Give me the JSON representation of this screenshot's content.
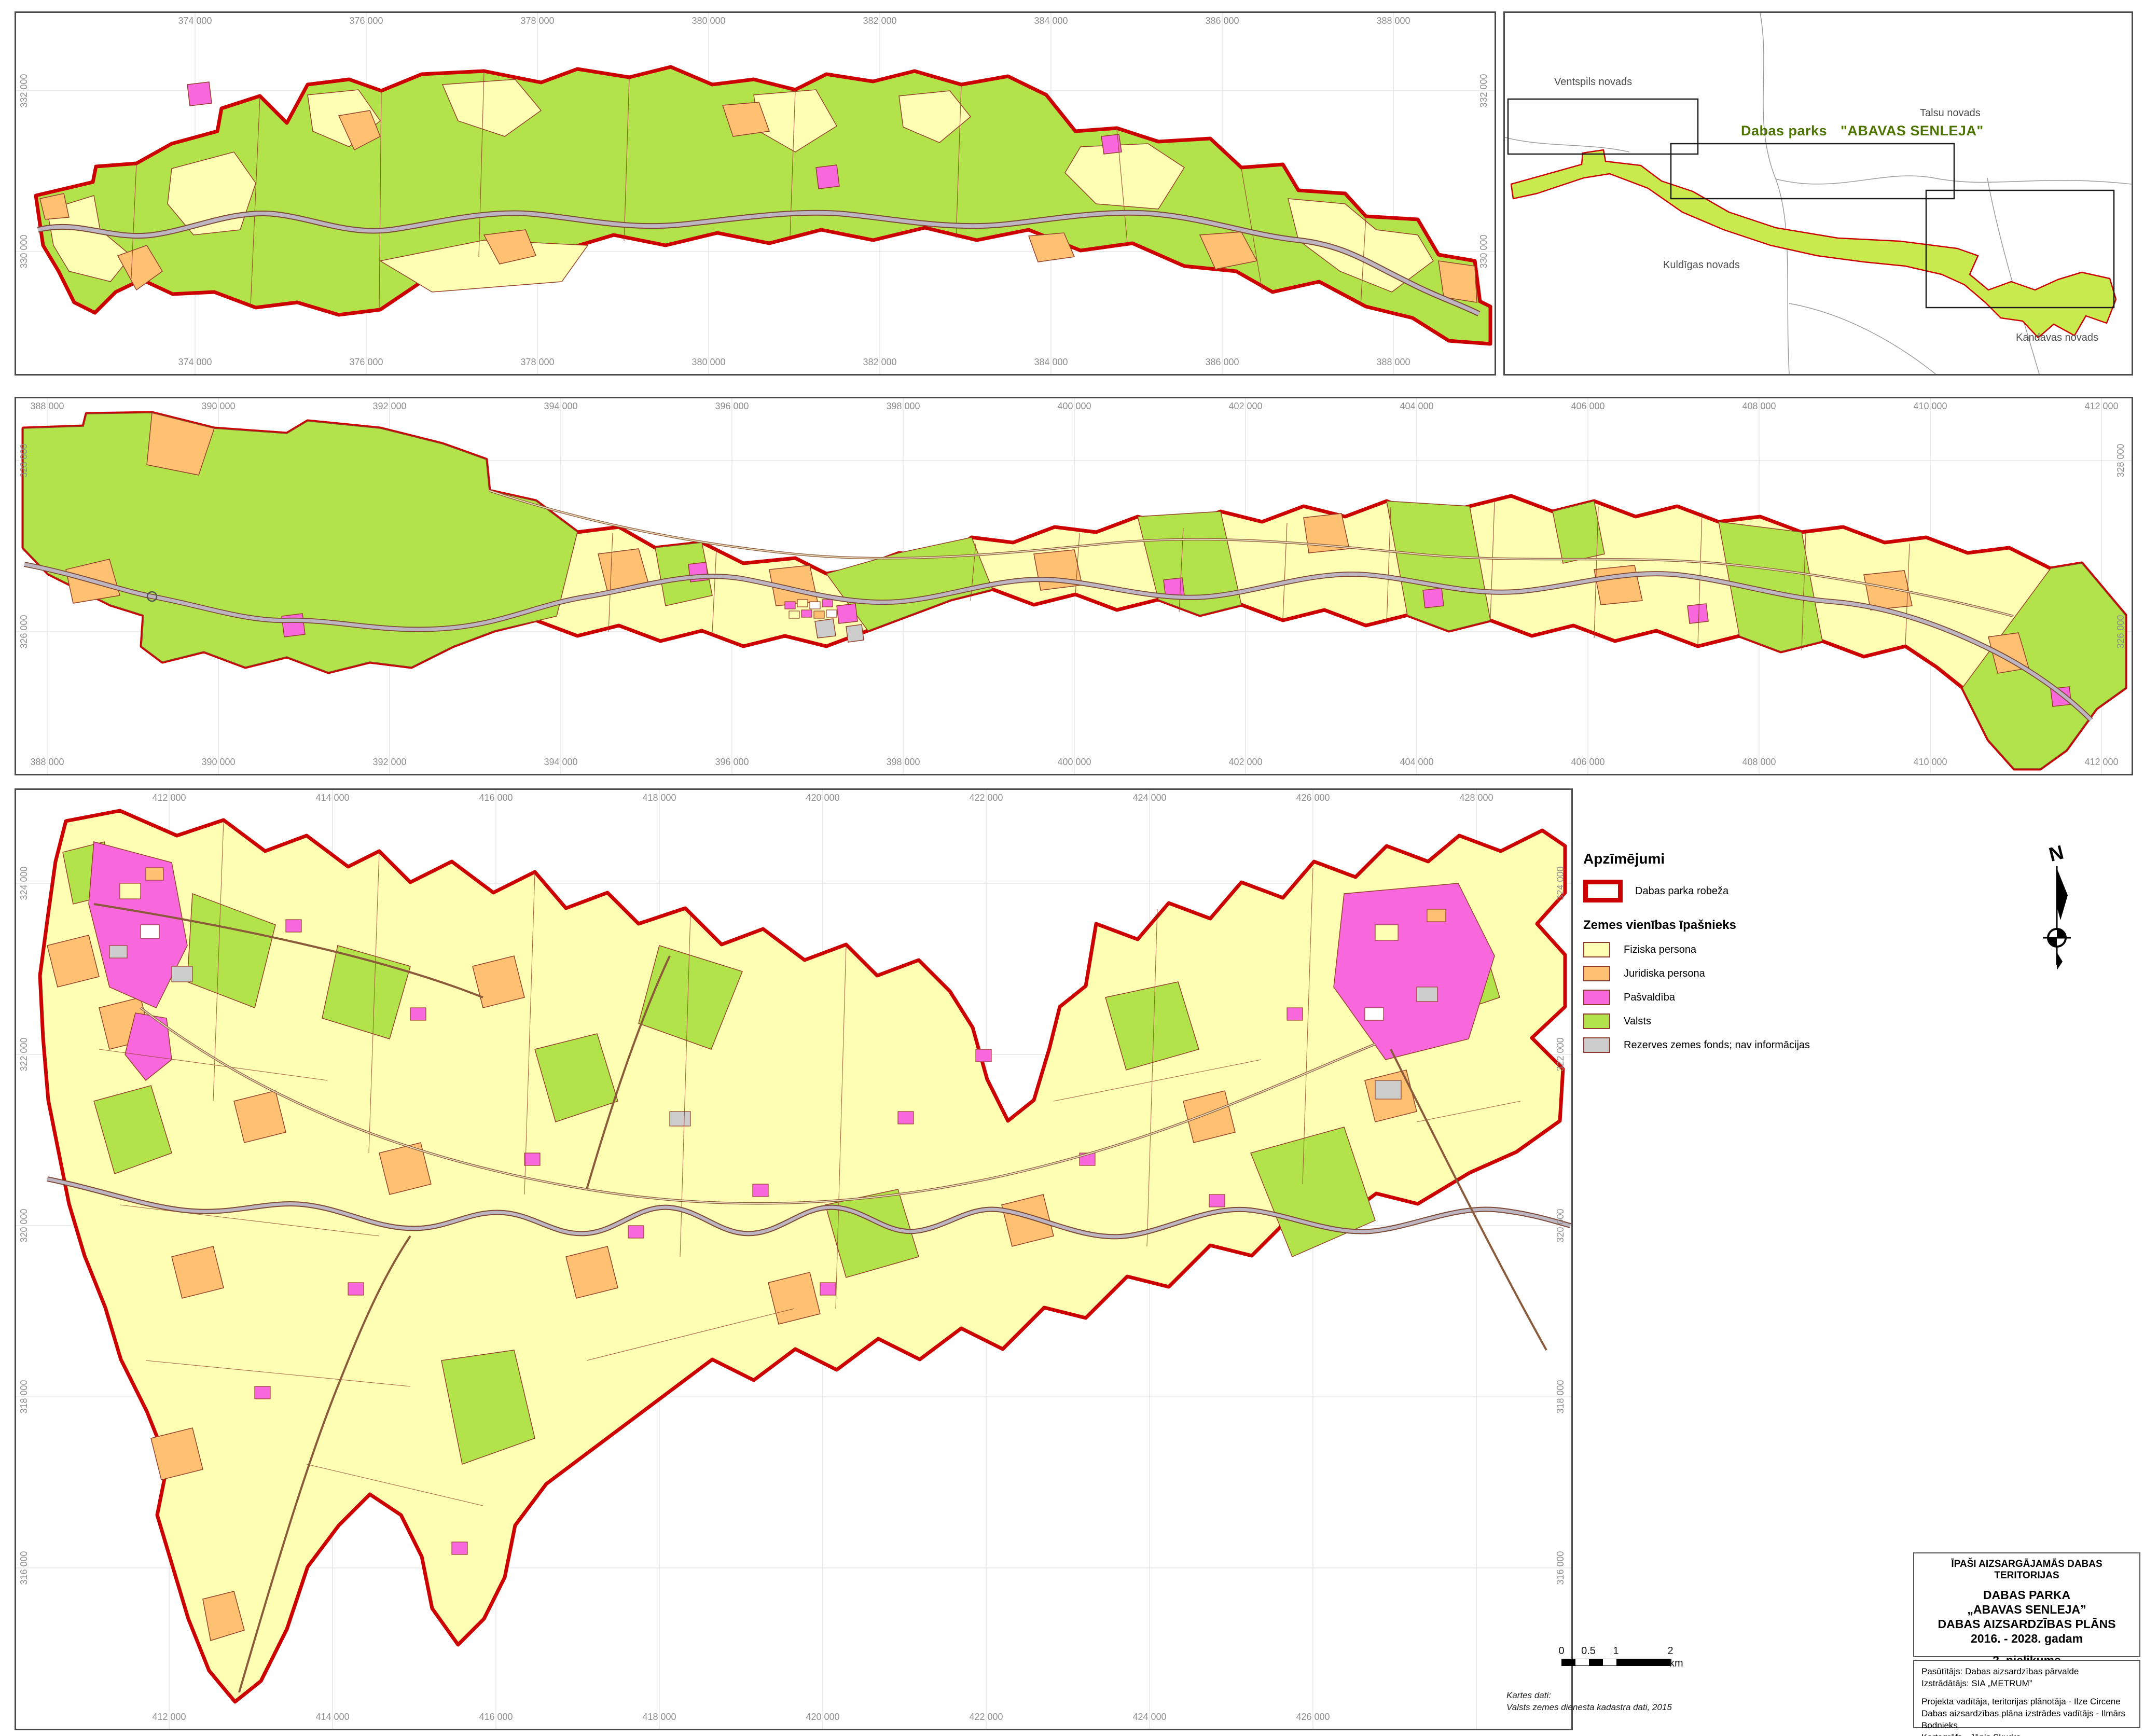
{
  "colors": {
    "park_boundary_red": "#CC0000",
    "fiziska_yellow": "#FFFFB4",
    "juridiska_orange": "#FDC171",
    "pasvaldiba_magenta": "#F967DC",
    "valsts_green": "#B3E34B",
    "rezerves_gray": "#CCCCCC",
    "parcel_line_brown": "#94402B",
    "river_gray": "#BDB6C2",
    "grid_gray": "#E0E0E0",
    "locator_park_green": "#C9EA4F",
    "locator_title_green": "#4C7300",
    "tick_label_gray": "#8E8E8E"
  },
  "maps": {
    "top": {
      "x_ticks": [
        "374 000",
        "376 000",
        "378 000",
        "380 000",
        "382 000",
        "384 000",
        "386 000",
        "388 000"
      ],
      "y_ticks": [
        "332 000",
        "330 000"
      ]
    },
    "middle": {
      "x_ticks": [
        "388 000",
        "390 000",
        "392 000",
        "394 000",
        "396 000",
        "398 000",
        "400 000",
        "402 000",
        "404 000",
        "406 000",
        "408 000",
        "410 000",
        "412 000"
      ],
      "y_ticks": [
        "328 000",
        "326 000"
      ]
    },
    "bottom": {
      "x_ticks_top": [
        "412 000",
        "414 000",
        "416 000",
        "418 000",
        "420 000",
        "422 000",
        "424 000",
        "426 000",
        "428 000"
      ],
      "x_ticks_bottom": [
        "412 000",
        "414 000",
        "416 000",
        "418 000",
        "420 000",
        "422 000",
        "424 000",
        "426 000"
      ],
      "y_ticks": [
        "324 000",
        "322 000",
        "320 000",
        "318 000",
        "316 000"
      ]
    }
  },
  "locator": {
    "region_labels": [
      "Ventspils novads",
      "Talsu novads",
      "Kuldīgas novads",
      "Kandavas novads"
    ],
    "title_prefix": "Dabas parks",
    "title_name": "\"ABAVAS SENLEJA\""
  },
  "legend": {
    "heading": "Apzīmējumi",
    "boundary_label": "Dabas parka robeža",
    "owner_heading": "Zemes vienības īpašnieks",
    "items": [
      {
        "label": "Fiziska persona",
        "color": "#FFFFB4"
      },
      {
        "label": "Juridiska persona",
        "color": "#FDC171"
      },
      {
        "label": "Pašvaldība",
        "color": "#F967DC"
      },
      {
        "label": "Valsts",
        "color": "#B3E34B"
      },
      {
        "label": "Rezerves zemes fonds; nav informācijas",
        "color": "#CCCCCC"
      }
    ]
  },
  "north": {
    "label": "N"
  },
  "scalebar": {
    "t0": "0",
    "t05": "0.5",
    "t1": "1",
    "t2": "2",
    "unit": "km"
  },
  "map_credits": {
    "line1": "Kartes dati:",
    "line2": "Valsts zemes dienesta kadastra dati, 2015"
  },
  "title_block": {
    "supertitle": "ĪPAŠI AIZSARGĀJAMĀS DABAS TERITORIJAS",
    "line1": "DABAS PARKA",
    "line2": "„ABAVAS SENLEJA”",
    "line3": "DABAS AIZSARDZĪBAS PLĀNS",
    "line4": "2016. - 2028. gadam",
    "line5": "2. pielikums",
    "line6": "Zemes īpašumtiesību sadalījums"
  },
  "credits_block": {
    "line1": "Pasūtītājs: Dabas aizsardzības pārvalde",
    "line2": "Izstrādātājs: SIA „METRUM”",
    "line3": "Projekta vadītāja, teritorijas plānotāja - Ilze Circene",
    "line4": "Dabas aizsardzības plāna izstrādes vadītājs - Ilmārs Bodnieks",
    "line5": "Kartogrāfs - Jānis Skudra"
  }
}
